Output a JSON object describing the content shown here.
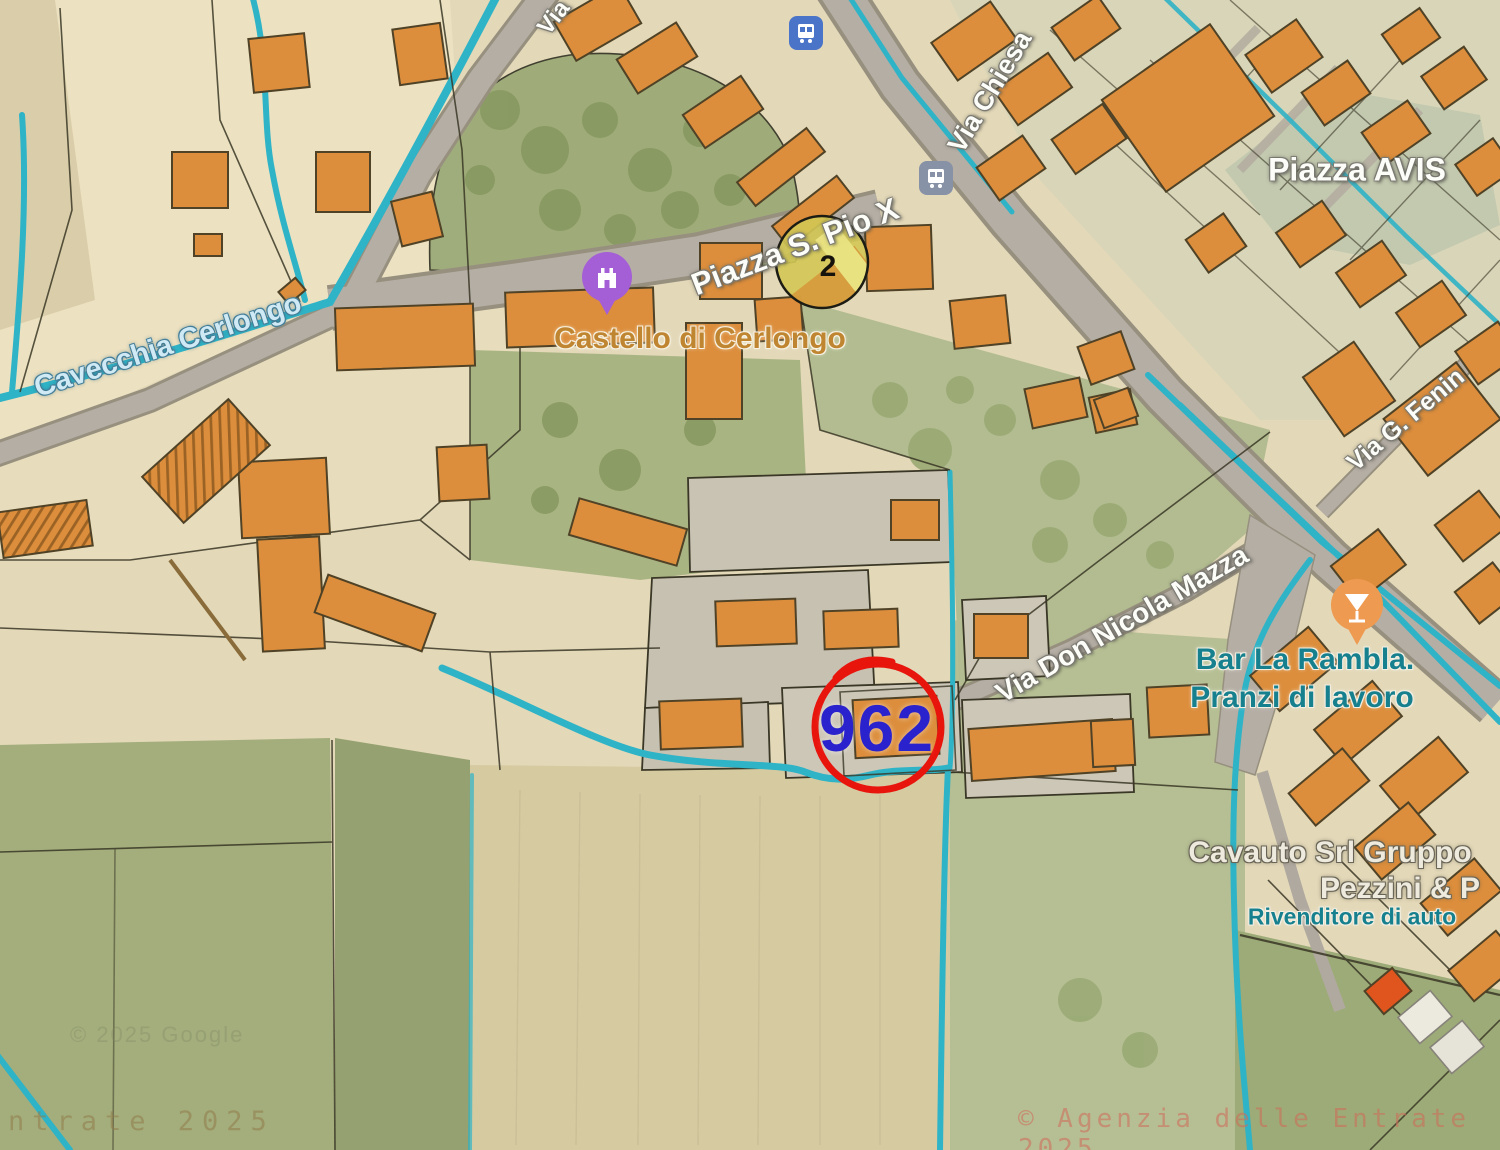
{
  "palette": {
    "building_orange": "#dc8e3c",
    "road_gray": "#b5aea5",
    "canal_teal": "#2fb3c6",
    "field_green": "#a3ae7c",
    "field_tan": "#e3d8b8",
    "annotation_circle_red": "#e8150d",
    "annotation_number_blue": "#2a22cd",
    "zone_circle_yellow": "#d2c654",
    "castle_pin_purple": "#a45fd6",
    "bar_pin_orange": "#ee9a50"
  },
  "labels": {
    "roads": {
      "via_partial": "Via",
      "via_chiesa": "Via Chiesa",
      "piazza_s_pio_x": "Piazza S. Pio X",
      "piazza_avis": "Piazza AVIS",
      "via_don_nicola_mazza": "Via Don Nicola Mazza",
      "via_g_fenin": "Via G. Fenin"
    },
    "water": {
      "cavecchia_cerlongo": "Cavecchia Cerlongo"
    },
    "pois": {
      "castello": "Castello di Cerlongo",
      "bar_line1": "Bar La Rambla.",
      "bar_line2": "Pranzi di lavoro",
      "cavauto_line1": "Cavauto Srl Gruppo",
      "cavauto_line2": "Pezzini & P",
      "cavauto_line3": "Rivenditore di auto"
    }
  },
  "annotations": {
    "parcel_number": "962",
    "zone_number": "2"
  },
  "watermarks": {
    "bottom_left": "ntrate 2025",
    "bottom_right": "© Agenzia delle Entrate 2025",
    "google": "© 2025 Google"
  },
  "icons": {
    "bus_stop_top": "bus-stop",
    "bus_stop_right": "bus-stop",
    "castle_pin": "castle",
    "cocktail_pin": "cocktail"
  }
}
